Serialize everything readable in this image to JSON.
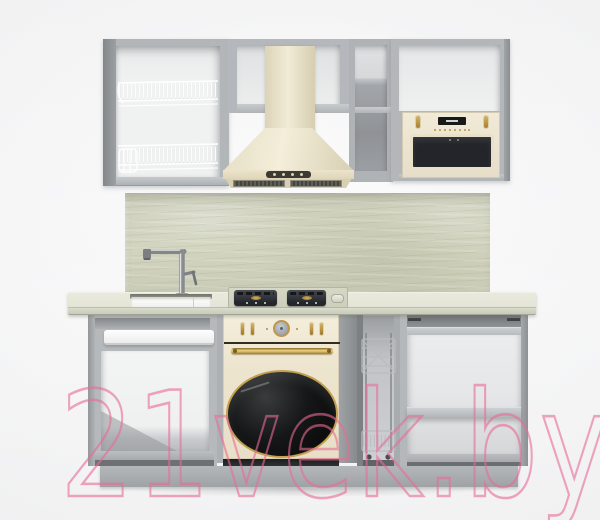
{
  "scene": {
    "type": "product-render",
    "subject": "kitchen-set-with-cream-retro-appliances",
    "background_color": "#f6f6f7"
  },
  "watermark": {
    "text": "21vek.by",
    "color": "#e86a94"
  },
  "palette": {
    "carcass_gray": "#b4b7ba",
    "carcass_side_gray": "#8f9295",
    "interior_white": "#f0f1f2",
    "cream": "#ebe3cd",
    "gold": "#bf9a4e",
    "appliance_black": "#222324",
    "backsplash_marble": "#cdcfba",
    "countertop_marble": "#e7e8db",
    "chrome": "#a3a7aa",
    "plinth_gray": "#a9acaf",
    "watermark_pink": "#e86a94"
  },
  "visible_counts": {
    "hood_buttons": 4,
    "dish_racks": 2,
    "gas_burners": 2,
    "oven_side_knobs": 4,
    "microwave_knobs": 2
  }
}
